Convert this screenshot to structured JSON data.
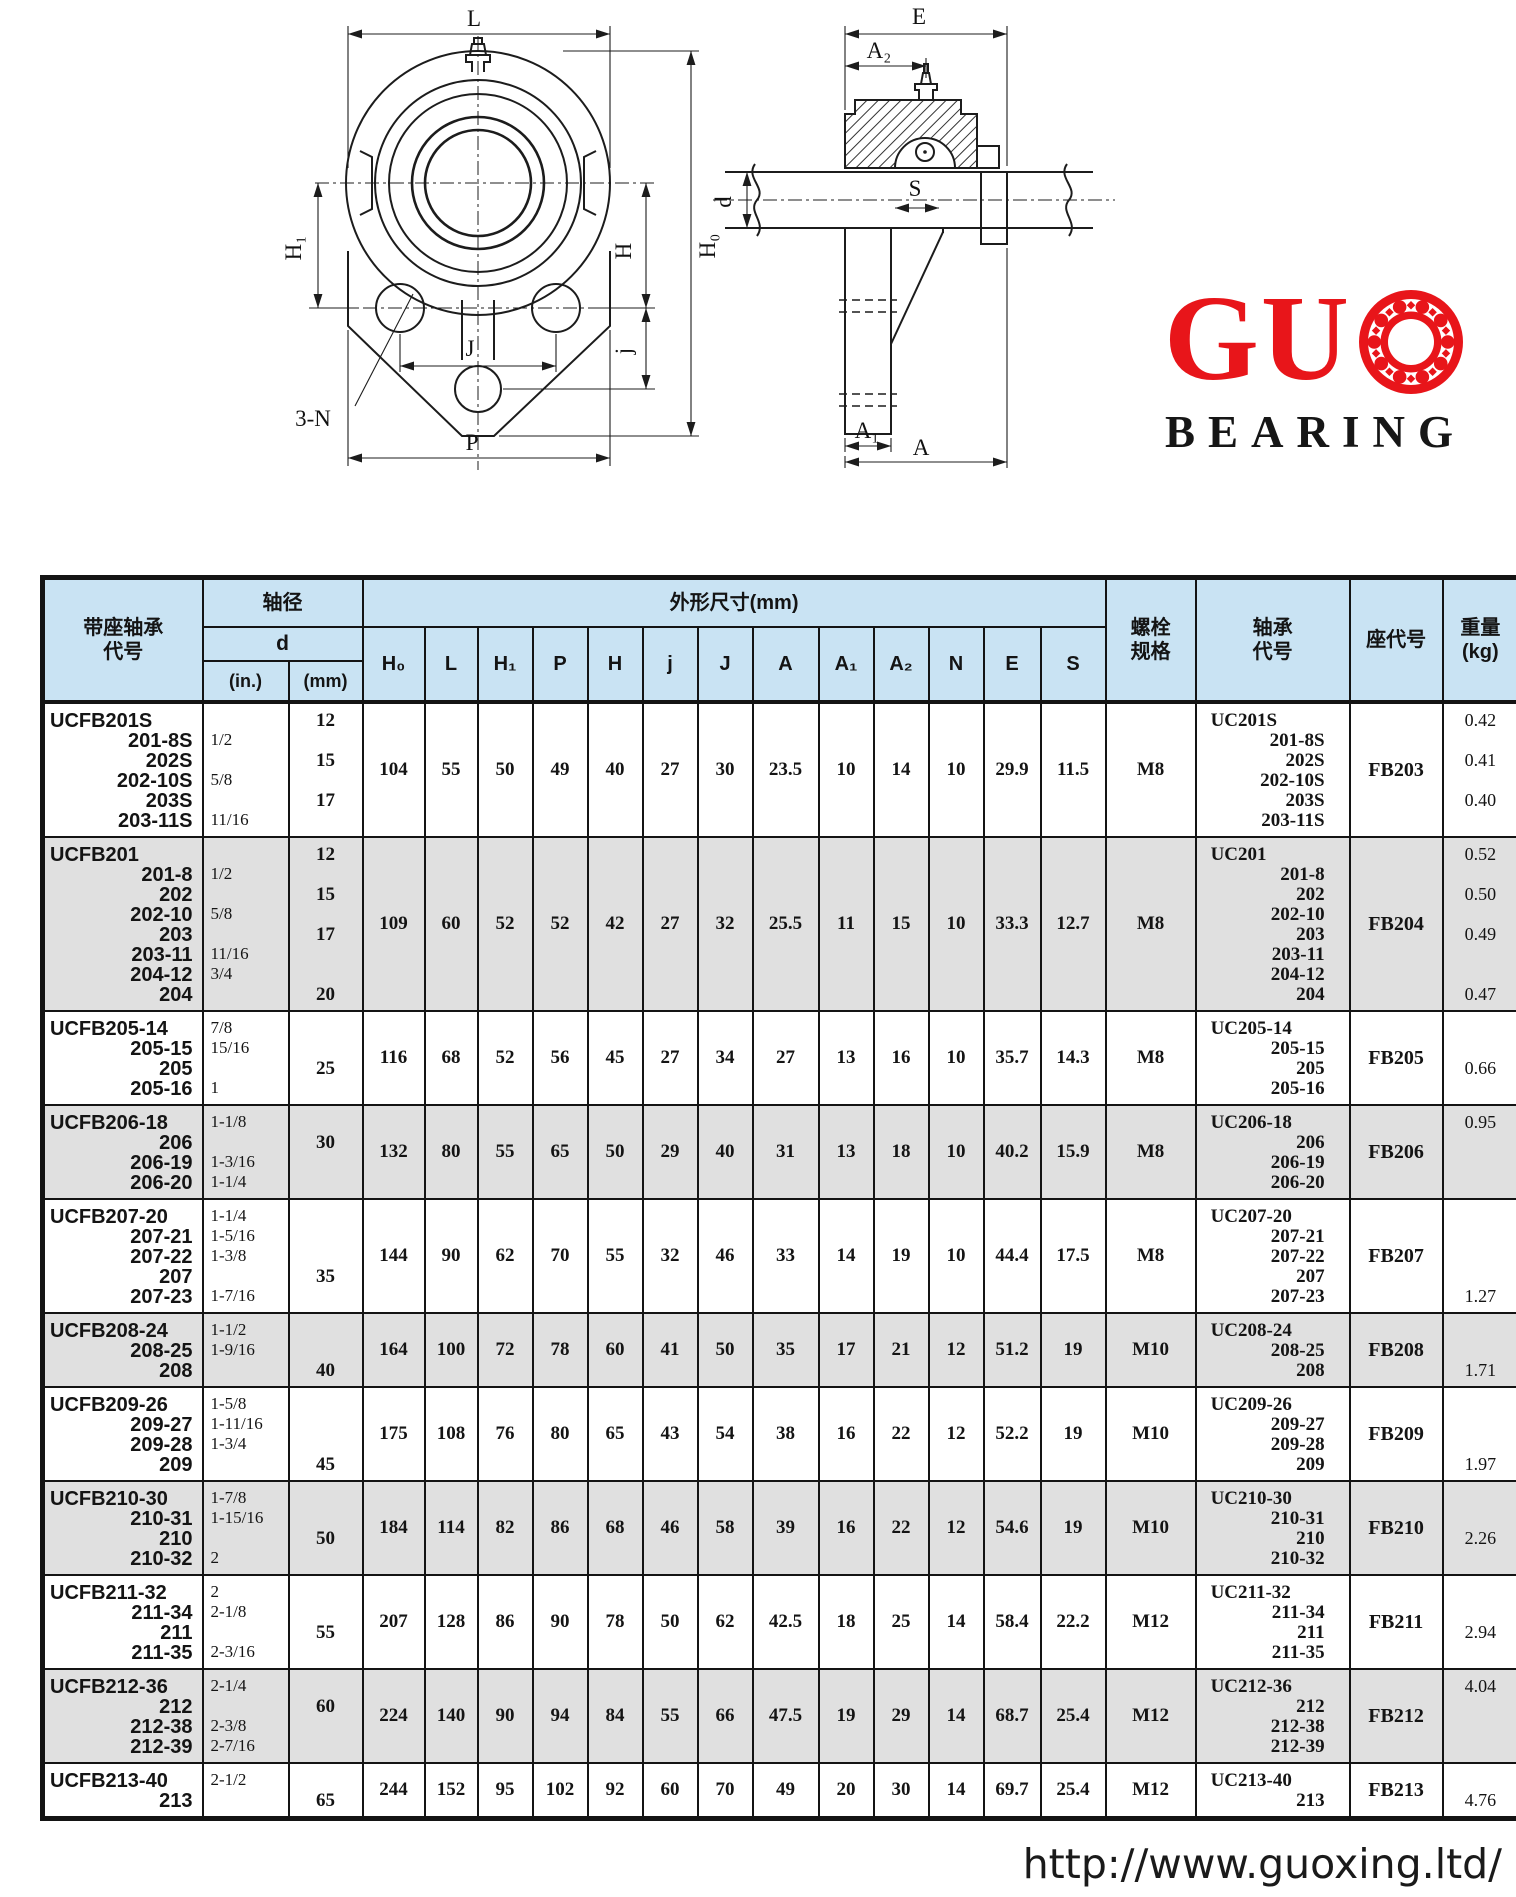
{
  "colors": {
    "header_bg": "#c9e3f3",
    "row_shaded": "#e0e0e0",
    "logo_red": "#e8151a",
    "line": "#141414"
  },
  "logo": {
    "gu": "GU",
    "bearing": "BEARING"
  },
  "footer": {
    "url": "http://www.guoxing.ltd/"
  },
  "diagram_front": {
    "labels": {
      "L": "L",
      "H1": "H₁",
      "N3": "3-N",
      "J": "J",
      "j": "j",
      "H": "H",
      "H0": "H₀",
      "P": "P"
    }
  },
  "diagram_side": {
    "labels": {
      "E": "E",
      "A2": "A₂",
      "S": "S",
      "d": "d",
      "A1": "A₁",
      "A": "A"
    }
  },
  "table": {
    "header": {
      "unit_code": "带座轴承\n代号",
      "shaft_dia": "轴径",
      "d": "d",
      "inch": "(in.)",
      "mm": "(mm)",
      "dims_title": "外形尺寸(mm)",
      "dim_cols": [
        "H₀",
        "L",
        "H₁",
        "P",
        "H",
        "j",
        "J",
        "A",
        "A₁",
        "A₂",
        "N",
        "E",
        "S"
      ],
      "bolt": "螺栓\n规格",
      "bearing_code": "轴承\n代号",
      "housing_code": "座代号",
      "weight": "重量\n(kg)"
    },
    "rows": [
      {
        "codes": [
          "UCFB201S",
          "201-8S",
          "202S",
          "202-10S",
          "203S",
          "203-11S"
        ],
        "inch": [
          "",
          "1/2",
          "",
          "5/8",
          "",
          "11/16"
        ],
        "mm": [
          "12",
          "",
          "15",
          "",
          "17",
          ""
        ],
        "dims": [
          "104",
          "55",
          "50",
          "49",
          "40",
          "27",
          "30",
          "23.5",
          "10",
          "14",
          "10",
          "29.9",
          "11.5"
        ],
        "bolt": "M8",
        "bearing": [
          "UC201S",
          "201-8S",
          "202S",
          "202-10S",
          "203S",
          "203-11S"
        ],
        "housing": "FB203",
        "weights": [
          "0.42",
          "",
          "0.41",
          "",
          "0.40",
          ""
        ],
        "shaded": false
      },
      {
        "codes": [
          "UCFB201",
          "201-8",
          "202",
          "202-10",
          "203",
          "203-11",
          "204-12",
          "204"
        ],
        "inch": [
          "",
          "1/2",
          "",
          "5/8",
          "",
          "11/16",
          "3/4",
          ""
        ],
        "mm": [
          "12",
          "",
          "15",
          "",
          "17",
          "",
          "",
          "20"
        ],
        "dims": [
          "109",
          "60",
          "52",
          "52",
          "42",
          "27",
          "32",
          "25.5",
          "11",
          "15",
          "10",
          "33.3",
          "12.7"
        ],
        "bolt": "M8",
        "bearing": [
          "UC201",
          "201-8",
          "202",
          "202-10",
          "203",
          "203-11",
          "204-12",
          "204"
        ],
        "housing": "FB204",
        "weights": [
          "0.52",
          "",
          "0.50",
          "",
          "0.49",
          "",
          "",
          "0.47"
        ],
        "shaded": true
      },
      {
        "codes": [
          "UCFB205-14",
          "205-15",
          "205",
          "205-16"
        ],
        "inch": [
          "7/8",
          "15/16",
          "",
          "1"
        ],
        "mm": [
          "",
          "",
          "25",
          ""
        ],
        "dims": [
          "116",
          "68",
          "52",
          "56",
          "45",
          "27",
          "34",
          "27",
          "13",
          "16",
          "10",
          "35.7",
          "14.3"
        ],
        "bolt": "M8",
        "bearing": [
          "UC205-14",
          "205-15",
          "205",
          "205-16"
        ],
        "housing": "FB205",
        "weights": [
          "",
          "",
          "0.66",
          ""
        ],
        "shaded": false
      },
      {
        "codes": [
          "UCFB206-18",
          "206",
          "206-19",
          "206-20"
        ],
        "inch": [
          "1-1/8",
          "",
          "1-3/16",
          "1-1/4"
        ],
        "mm": [
          "",
          "30",
          "",
          ""
        ],
        "dims": [
          "132",
          "80",
          "55",
          "65",
          "50",
          "29",
          "40",
          "31",
          "13",
          "18",
          "10",
          "40.2",
          "15.9"
        ],
        "bolt": "M8",
        "bearing": [
          "UC206-18",
          "206",
          "206-19",
          "206-20"
        ],
        "housing": "FB206",
        "weights": [
          "0.95",
          "",
          "",
          ""
        ],
        "shaded": true
      },
      {
        "codes": [
          "UCFB207-20",
          "207-21",
          "207-22",
          "207",
          "207-23"
        ],
        "inch": [
          "1-1/4",
          "1-5/16",
          "1-3/8",
          "",
          "1-7/16"
        ],
        "mm": [
          "",
          "",
          "",
          "35",
          ""
        ],
        "dims": [
          "144",
          "90",
          "62",
          "70",
          "55",
          "32",
          "46",
          "33",
          "14",
          "19",
          "10",
          "44.4",
          "17.5"
        ],
        "bolt": "M8",
        "bearing": [
          "UC207-20",
          "207-21",
          "207-22",
          "207",
          "207-23"
        ],
        "housing": "FB207",
        "weights": [
          "",
          "",
          "",
          "",
          "1.27"
        ],
        "shaded": false
      },
      {
        "codes": [
          "UCFB208-24",
          "208-25",
          "208"
        ],
        "inch": [
          "1-1/2",
          "1-9/16",
          ""
        ],
        "mm": [
          "",
          "",
          "40"
        ],
        "dims": [
          "164",
          "100",
          "72",
          "78",
          "60",
          "41",
          "50",
          "35",
          "17",
          "21",
          "12",
          "51.2",
          "19"
        ],
        "bolt": "M10",
        "bearing": [
          "UC208-24",
          "208-25",
          "208"
        ],
        "housing": "FB208",
        "weights": [
          "",
          "",
          "1.71"
        ],
        "shaded": true
      },
      {
        "codes": [
          "UCFB209-26",
          "209-27",
          "209-28",
          "209"
        ],
        "inch": [
          "1-5/8",
          "1-11/16",
          "1-3/4",
          ""
        ],
        "mm": [
          "",
          "",
          "",
          "45"
        ],
        "dims": [
          "175",
          "108",
          "76",
          "80",
          "65",
          "43",
          "54",
          "38",
          "16",
          "22",
          "12",
          "52.2",
          "19"
        ],
        "bolt": "M10",
        "bearing": [
          "UC209-26",
          "209-27",
          "209-28",
          "209"
        ],
        "housing": "FB209",
        "weights": [
          "",
          "",
          "",
          "1.97"
        ],
        "shaded": false
      },
      {
        "codes": [
          "UCFB210-30",
          "210-31",
          "210",
          "210-32"
        ],
        "inch": [
          "1-7/8",
          "1-15/16",
          "",
          "2"
        ],
        "mm": [
          "",
          "",
          "50",
          ""
        ],
        "dims": [
          "184",
          "114",
          "82",
          "86",
          "68",
          "46",
          "58",
          "39",
          "16",
          "22",
          "12",
          "54.6",
          "19"
        ],
        "bolt": "M10",
        "bearing": [
          "UC210-30",
          "210-31",
          "210",
          "210-32"
        ],
        "housing": "FB210",
        "weights": [
          "",
          "",
          "2.26",
          ""
        ],
        "shaded": true
      },
      {
        "codes": [
          "UCFB211-32",
          "211-34",
          "211",
          "211-35"
        ],
        "inch": [
          "2",
          "2-1/8",
          "",
          "2-3/16"
        ],
        "mm": [
          "",
          "",
          "55",
          ""
        ],
        "dims": [
          "207",
          "128",
          "86",
          "90",
          "78",
          "50",
          "62",
          "42.5",
          "18",
          "25",
          "14",
          "58.4",
          "22.2"
        ],
        "bolt": "M12",
        "bearing": [
          "UC211-32",
          "211-34",
          "211",
          "211-35"
        ],
        "housing": "FB211",
        "weights": [
          "",
          "",
          "2.94",
          ""
        ],
        "shaded": false
      },
      {
        "codes": [
          "UCFB212-36",
          "212",
          "212-38",
          "212-39"
        ],
        "inch": [
          "2-1/4",
          "",
          "2-3/8",
          "2-7/16"
        ],
        "mm": [
          "",
          "60",
          "",
          ""
        ],
        "dims": [
          "224",
          "140",
          "90",
          "94",
          "84",
          "55",
          "66",
          "47.5",
          "19",
          "29",
          "14",
          "68.7",
          "25.4"
        ],
        "bolt": "M12",
        "bearing": [
          "UC212-36",
          "212",
          "212-38",
          "212-39"
        ],
        "housing": "FB212",
        "weights": [
          "4.04",
          "",
          "",
          ""
        ],
        "shaded": true
      },
      {
        "codes": [
          "UCFB213-40",
          "213"
        ],
        "inch": [
          "2-1/2",
          ""
        ],
        "mm": [
          "",
          "65"
        ],
        "dims": [
          "244",
          "152",
          "95",
          "102",
          "92",
          "60",
          "70",
          "49",
          "20",
          "30",
          "14",
          "69.7",
          "25.4"
        ],
        "bolt": "M12",
        "bearing": [
          "UC213-40",
          "213"
        ],
        "housing": "FB213",
        "weights": [
          "",
          "4.76"
        ],
        "shaded": false
      }
    ]
  }
}
